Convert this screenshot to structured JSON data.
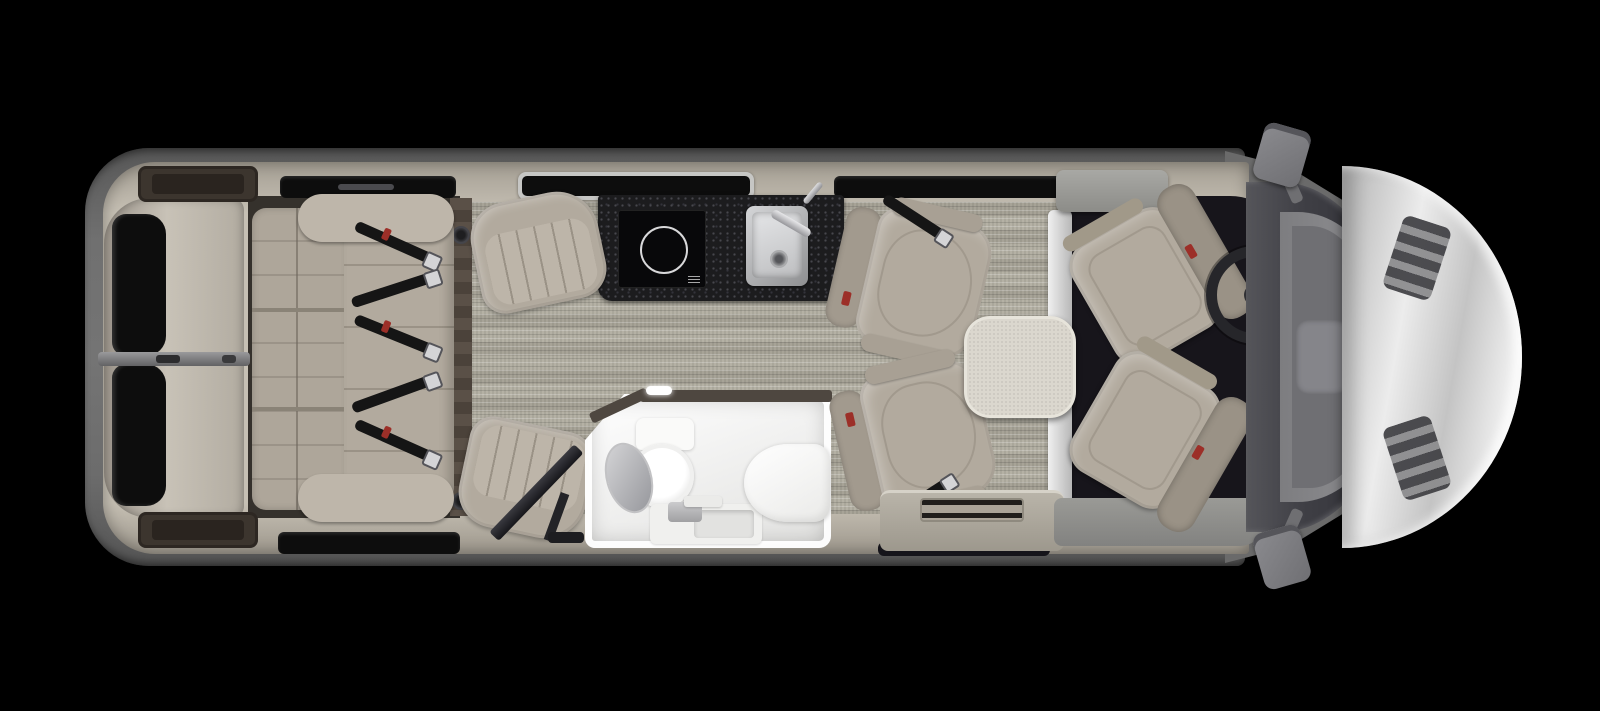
{
  "scene": {
    "description": "Top-down 3D rendered floor plan of a Class B motorhome interior on a black background",
    "visible_text": []
  },
  "colors": {
    "bg": "#000000",
    "body_gray": "#6e6e6e",
    "wall_beige": "#c6c0b4",
    "cabinet_wood": "#3c352e",
    "carpet_base": "#b0ac9f",
    "upholstery": "#b2aa9e",
    "upholstery_light": "#bdb5a9",
    "seam": "#9a9286",
    "counter_black": "#1c1c1e",
    "window_glass": "#0d0d0d",
    "cab_floor": "#17151b",
    "table_top": "#dbd7ce",
    "bath_white": "#f4f4f3",
    "hood_silver": "#e0e0e0",
    "belt_black": "#151515",
    "belt_red": "#9c2f28",
    "buckle_silver": "#d4d4d6"
  },
  "labels": {
    "vehicle": "RV floor plan – top view",
    "rear_doors": "Rear twin doors with windows",
    "rear_window": "Rear door window",
    "rear_cabinet": "Rear overhead cabinet",
    "sofa": "Rear sofa with seat belts",
    "seat_belt": "Seat belt with buckle",
    "awning_window": "Awning window",
    "speakers": "Floor speakers",
    "counter": "Galley counter",
    "cooktop": "Induction cooktop",
    "kitchen_sink": "Stainless kitchen sink",
    "lounge_chair": "Lounge chair",
    "tv": "TV on swivel arm",
    "bathroom": "Wet bath",
    "toilet": "Toilet with open lid",
    "bath_sink": "Vanity sink",
    "shower_bench": "Shower bench",
    "swivel_chair": "Swivel captain chair with belt",
    "table": "Pedestal table",
    "partition": "Step partition",
    "entry_step": "Entry door step",
    "driver_seat": "Driver seat (swiveled rearward)",
    "passenger_seat": "Passenger seat (swiveled rearward)",
    "steering_wheel": "Steering wheel",
    "console": "Center console with radio",
    "gear": "Gear shifter pod",
    "windshield": "Windshield",
    "dashboard": "Dashboard",
    "hood": "Front hood",
    "hood_vent": "Hood vent grille",
    "mirror": "Side mirror",
    "carpet": "Living area carpet",
    "cab_floor": "Cab floor mat",
    "step_grille": "Step vent grille"
  }
}
